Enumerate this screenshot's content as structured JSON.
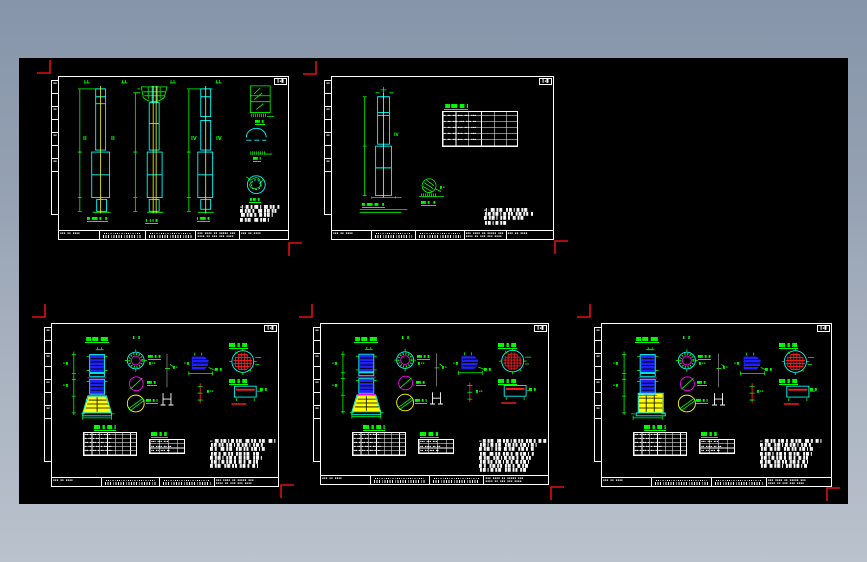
{
  "window": {
    "background_top": "#8695a9",
    "background_bottom": "#bac2cd",
    "canvas_color": "#000000"
  },
  "palette": {
    "line_white": "#ffffff",
    "line_cyan": "#00ffff",
    "line_green": "#00ff00",
    "line_yellow": "#ffff00",
    "line_magenta": "#ff00ff",
    "fill_blue": "#2020ff",
    "line_red": "#ff2020",
    "crop_mark_red": "#e01010"
  },
  "glyphs": {
    "strip": "▪▪",
    "corner": "▌▪█",
    "tiny": "▪▪▪",
    "tiny2": "▪▪ ▪▪▪",
    "tb_sign": "▪▪▪ ▪▪ ▪▪▪▪",
    "tb_dense": "▪▪▪ ▪▪▪▪ ▪▪ ▪▪▪▪▪ ▪▪▪\n▪▪▪▪ ▪▪ ▪▪▪ ▪▪▪ ▪▪▪▪",
    "table_s2": "▪ ▪▪ ▪▪ ▪▪▪ ▪▪▪ ▪▪▪\n▪ ▪▪ ▪▪▪ ▪▪▪ ▪▪▪ ▪▪\n▪ ▪▪ ▪▪ ▪▪▪ ▪▪▪ ▪▪▪\n▪ ▪▪ ▪▪ ▪▪▪ ▪▪▪ ▪▪▪\n▪ ▪▪ ▪▪ ▪▪▪ ▪▪▪ ▪▪▪",
    "table_t1": "▪▪ ▪ ▪▪ ▪ ▪ ▪▪ ▪\n▪ ▪▪ ▪ ▪▪ ▪▪ ▪ ▪▪\n▪▪ ▪ ▪▪ ▪ ▪▪ ▪ ▪\n▪ ▪▪ ▪ ▪▪ ▪ ▪▪ ▪▪\n▪▪ ▪ ▪▪ ▪ ▪▪ ▪ ▪▪",
    "table_t2": "▪▪▪ ▪▪▪ ▪▪▪\n▪▪ ▪▪▪▪ ▪▪ ▪▪\n▪▪ ▪▪ ▪▪▪ ▪▪"
  },
  "sheets": {
    "s1": {
      "col_a_label_left": "II",
      "col_a_label_right": "II",
      "col_c_label_left": "IV",
      "col_c_label_right": "IV",
      "col_a_caption": "█▌▐██▌▐▌ ▐▌",
      "col_b_caption": "▐-▐ ▌▐▌",
      "col_c_caption": "▌▐██▌▐▌",
      "detail_1_caption": "██▌▐▌",
      "detail_2_caption": "██▌▐",
      "detail_3_caption": "▐▌█▌▐▌",
      "notes": "▪▌:█▌▐▌▐█▌▐ ▐█▌▐▌█ ▐▌\n█▌▐▌█▌▐▌ ▐█▌▐▌█▌▐▌█\n▐█▌▐▌█▌▐▌ █▌▐▌█▌▐\n█▌▐▌█▌ ▐█▌▐▌█▌▐"
    },
    "s2": {
      "shaft_label": "IV",
      "table_title": "▐█▌██▌▐█▌▐",
      "column_caption": "█▌▐██▌▐█▌ ▐▌",
      "detail_caption": "██▌▐▌ ▐▌",
      "detail_side": "▐▌▪",
      "notes": "▪▌:▐█▌▐▌█▌ ▐▌█▌▐ █▌▐▌█▌\n▐▌█▌▐▌█▌▐ █▌▐▌█ ▐▌█▌▐▌█ ▐▌\n█▌▐▌█▌▐ ▐▌█▌▐▌ █▌▐▌█▌\n▐▌█▌▐ █▌▐▌█▌"
    },
    "s3": {
      "title": "▐█▌██▌▐██▌",
      "section_label": "▌ ▌",
      "c1_caption": "██▌▐▌▐▌",
      "c1_sub": "▐▌▪▪",
      "c2_caption": "██▌▐▌",
      "c3_caption": "██▌▐▌▐",
      "center_label": "▐▌▪",
      "blob_label": "█▌▐▌",
      "blob_side": "▪▐▌",
      "redline_label": "▐▌▪▪",
      "grid_title": "██▌▐▌▐█▌",
      "rect_title": "██▌▐▌▐█▌",
      "rect_label": "█▌▐▌",
      "elev_label_1": "▪▐▌",
      "elev_label_2": "▪▐▌",
      "t1_title": "██▌▐▌▐█▌▐",
      "t2_title": "██▌▐▌▐▌",
      "notes": "▪:▐█▌▐▌█▌▐ █▌▐▌█▌ ▐█▌▐▌█ ▐▌█▌ ▐█▌▐\n▐▌█▌▐▌█ ▐▌█▌▐ █▌▐▌█▌▐ ▐▌█▌▐▌\n█▌▐▌ ▐█▌▐▌█▌ ▐▌█▌▐▌█ ▐▌█▌▐ █▌\n▐▌█▌▐▌ █▌▐▌█ ▐▌█▌▐▌█▌ ▐▌█▌\n█▌▐▌█▌▐ ▐▌█▌▐▌ █▌▐▌█▌ ▐▌█▌▐\n▐▌█▌▐ █▌▐▌█▌▐▌ █▌▐▌ █▌▐▌█\n█▌▐▌█▌ ▐▌█▌▐▌█ ▐▌█▌▐▌ █▌▐"
    },
    "s4": {
      "title": "▐█▌██▌▐██▌",
      "section_label": "▌ ▌",
      "c1_caption": "██▌▐▌▐▌",
      "c1_sub": "▐▌▪▪",
      "c2_caption": "██▌▐▌",
      "c3_caption": "██▌▐▌▐",
      "center_label": "▐▌▪",
      "blob_label": "█▌▐▌",
      "blob_side": "▪▐▌",
      "redline_label": "▐▌▪▪",
      "grid_title": "██▌▐▌▐█▌",
      "rect_title": "██▌▐▌▐█▌",
      "rect_label": "█▌▐▌",
      "elev_label_1": "▪▐▌",
      "elev_label_2": "▪▐▌",
      "t1_title": "██▌▐▌▐█▌▐",
      "t2_title": "██▌▐█▌▐▌",
      "notes": "▪:█▌▐▌█▌ ▐█▌▐▌█▌▐ █▌▐▌█ ▐▌█▌▐▌ █▌▐█\n▐▌█▌▐ █▌▐▌█▌ ▐▌█▌▐▌█ ▐▌█▌▐ █▌▐\n█▌▐▌█▌▐ ▐▌█▌ █▌▐▌█▌ ▐▌█▌▐▌ █▌\n▐▌█▌ ▐█▌▐▌█ ▐▌█▌▐▌ █▌▐▌█▌▐ ▐▌\n█▌▐▌█▌ ▐▌█▌▐ █▌▐▌█▌▐▌ █▌▐▌█\n▐▌█▌▐▌█ ▐▌█▌▐ █▌▐▌ █▌▐▌█▌▐\n█▌▐▌ ▐▌█▌▐▌█ ▐▌█▌▐▌ █▌▐▌█▌\n▐▌█▌▐ █▌▐▌█▌ ▐▌█▌▐▌█ ▐▌█▌"
    },
    "s5": {
      "title": "▐█▌██▌▐██▌",
      "section_label": "▌ ▌",
      "c1_caption": "██▌▐▌▐▌",
      "c1_sub": "▐▌▪▪",
      "c2_caption": "██▌▐▌",
      "c3_caption": "██▌▐▌▐",
      "center_label": "▐▌▪",
      "blob_label": "█▌▐▌",
      "blob_side": "▪▐▌",
      "redline_label": "▐▌▪▪",
      "grid_title": "██▌▐▌▐█▌",
      "rect_title": "██▌▐▌▐█▌",
      "rect_label": "█▌▐▌",
      "elev_label_1": "▪▐▌",
      "elev_label_2": "▪▐▌",
      "t1_title": "██▌▐▌▐█▌▐",
      "t2_title": "██▌▐▌▐▌",
      "notes": "▪:▐█▌▐▌█ ▐▌█▌▐▌ █▌▐▌█▌ ▐█▌▐▌ █▌▐\n█▌▐▌█▌ ▐▌█▌▐ █▌▐▌█▌▐ ▐▌█▌▐▌\n▐▌█▌ █▌▐▌█▌ ▐▌█▌▐▌█ ▐▌█▌▐ █▌\n█▌▐▌█▌▐ ▐▌█▌▐▌ █▌▐▌█▌ ▐▌█▌▐\n▐▌█▌▐ █▌▐▌█▌▐▌ █▌▐▌ █▌▐▌█\n█▌▐▌█▌ ▐▌█▌▐▌█ ▐▌█▌▐▌ █▌▐\n▐▌█▌ █▌▐▌█▌▐ ▐▌█▌▐▌█▌▐ █▌"
    }
  }
}
